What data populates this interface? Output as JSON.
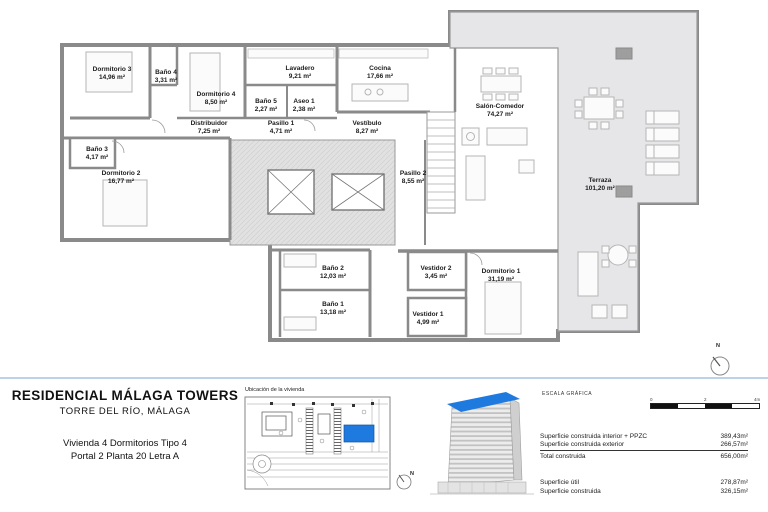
{
  "colors": {
    "accent": "#1f7ae0",
    "walls": "#8a8a8a",
    "terrace_fill": "#e6e6e8",
    "core_fill": "#e1e1e1",
    "divider": "#b9d3e7"
  },
  "plan": {
    "compass": "N",
    "rooms": [
      {
        "name": "Dormitorio 3",
        "area": "14,96 m²"
      },
      {
        "name": "Baño 4",
        "area": "3,31 m²"
      },
      {
        "name": "Dormitorio 4",
        "area": "8,50 m²"
      },
      {
        "name": "Lavadero",
        "area": "9,21 m²"
      },
      {
        "name": "Cocina",
        "area": "17,66 m²"
      },
      {
        "name": "Baño 5",
        "area": "2,27 m²"
      },
      {
        "name": "Aseo 1",
        "area": "2,38 m²"
      },
      {
        "name": "Distribuidor",
        "area": "7,25 m²"
      },
      {
        "name": "Pasillo 1",
        "area": "4,71 m²"
      },
      {
        "name": "Vestíbulo",
        "area": "8,27 m²"
      },
      {
        "name": "Baño 3",
        "area": "4,17 m²"
      },
      {
        "name": "Dormitorio 2",
        "area": "16,77 m²"
      },
      {
        "name": "Pasillo 2",
        "area": "8,55 m²"
      },
      {
        "name": "Salón-Comedor",
        "area": "74,27 m²"
      },
      {
        "name": "Terraza",
        "area": "101,20 m²"
      },
      {
        "name": "Baño 2",
        "area": "12,03 m²"
      },
      {
        "name": "Baño 1",
        "area": "13,18 m²"
      },
      {
        "name": "Vestidor 2",
        "area": "3,45 m²"
      },
      {
        "name": "Vestidor 1",
        "area": "4,99 m²"
      },
      {
        "name": "Dormitorio 1",
        "area": "31,19 m²"
      }
    ]
  },
  "project": {
    "title": "RESIDENCIAL MÁLAGA TOWERS",
    "subtitle": "TORRE DEL RÍO, MÁLAGA",
    "unit_line1": "Vivienda 4 Dormitorios Tipo 4",
    "unit_line2": "Portal 2 Planta 20 Letra A"
  },
  "location": {
    "title": "Ubicación de la vivienda",
    "compass": "N"
  },
  "scale": {
    "title": "ESCALA GRÁFICA",
    "ticks": [
      "0",
      "2",
      "4m"
    ]
  },
  "surfaces": {
    "group1": [
      {
        "label": "Superficie construida interior + PPZC",
        "value": "389,43m²"
      },
      {
        "label": "Superficie construida exterior",
        "value": "266,57m²"
      },
      {
        "label": "Total construida",
        "value": "656,00m²"
      }
    ],
    "group2": [
      {
        "label": "Superficie útil",
        "value": "278,87m²"
      },
      {
        "label": "Superficie construida",
        "value": "326,15m²"
      }
    ]
  }
}
